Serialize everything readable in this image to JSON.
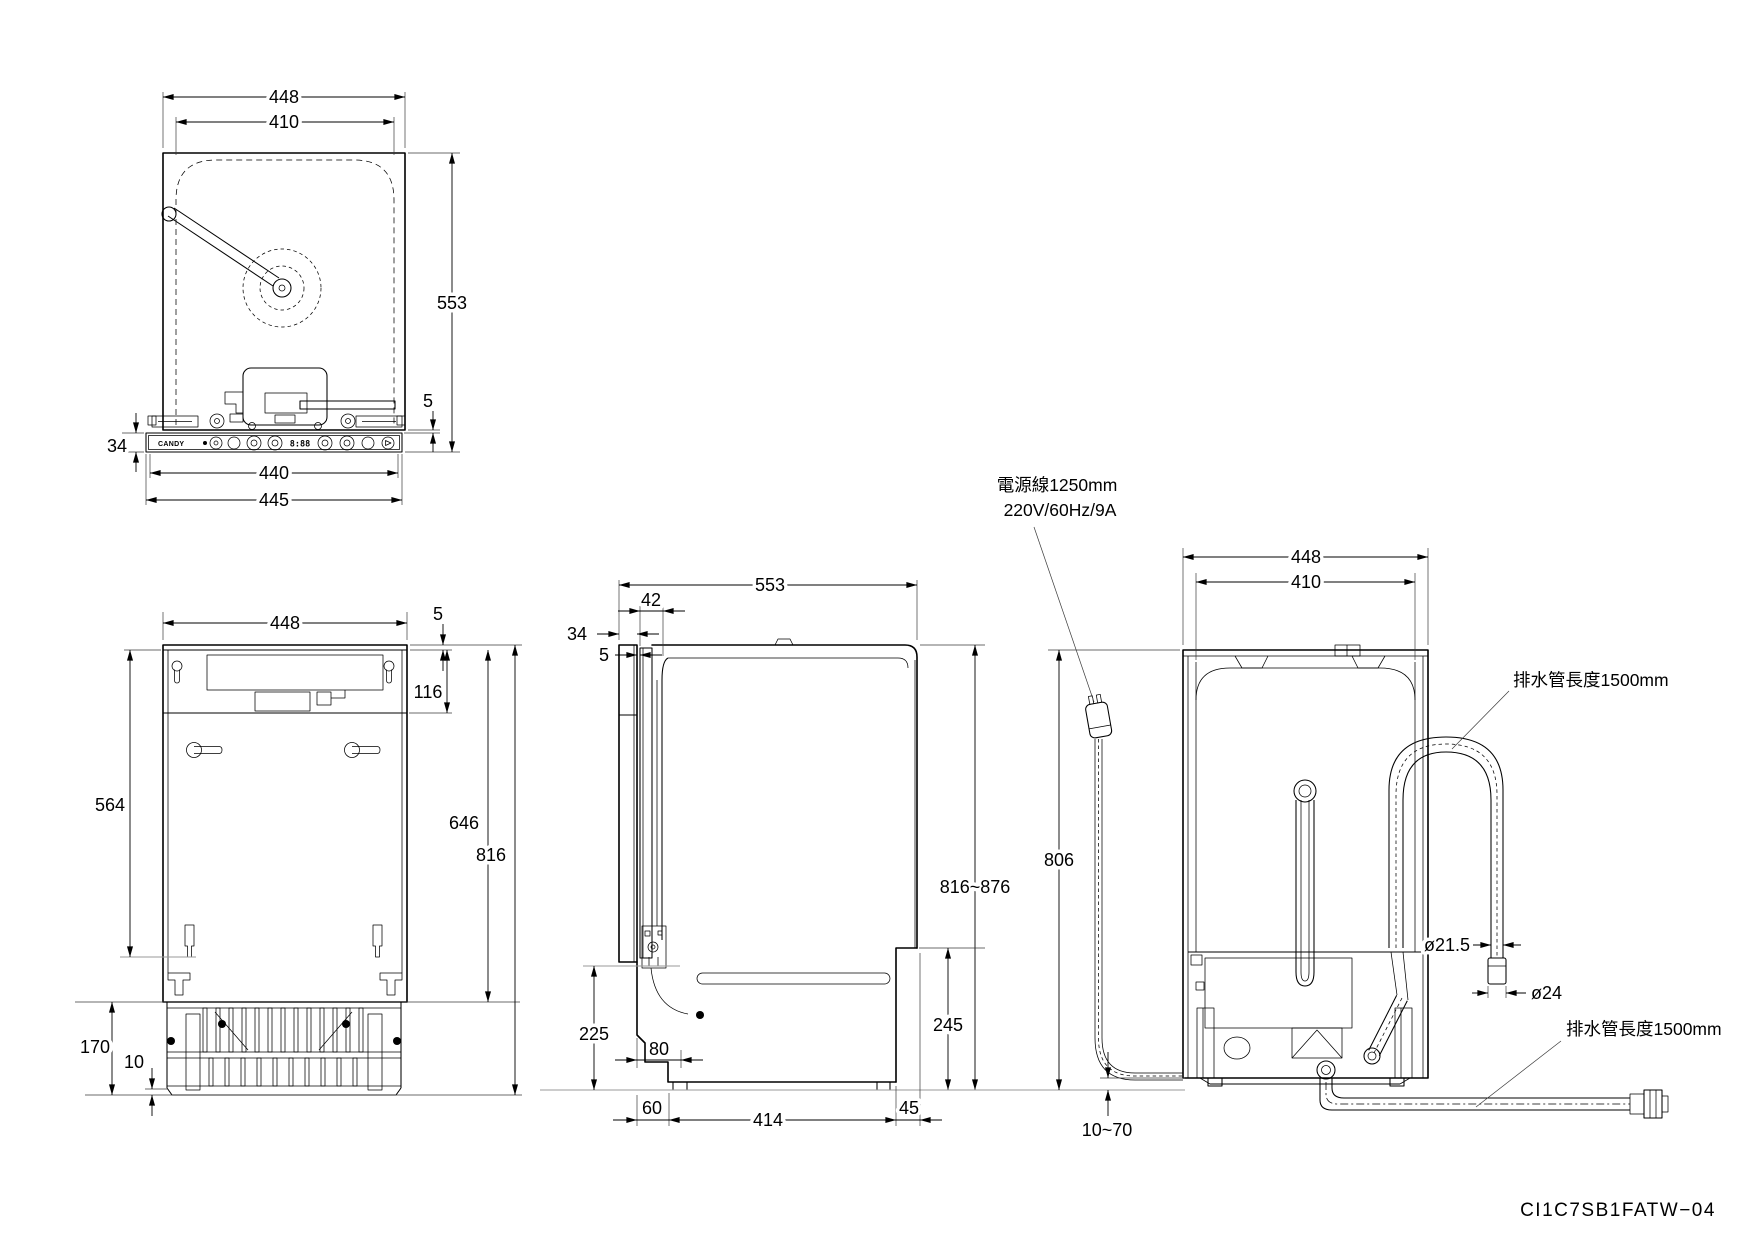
{
  "drawing": {
    "part_number": "CI1C7SB1FATW−04"
  },
  "top_view": {
    "width_outer": "448",
    "width_door": "410",
    "depth": "553",
    "gap_body_panel": "5",
    "panel_height": "34",
    "panel_width_inner": "440",
    "panel_width_outer": "445",
    "brand": "CANDY",
    "display": "8:88"
  },
  "front_view": {
    "width": "448",
    "top_gap": "5",
    "top_section": "116",
    "side_height": "564",
    "tub_height": "646",
    "overall_height": "816",
    "base_height": "170",
    "base_lip": "10"
  },
  "side_view": {
    "depth": "553",
    "door_offset": "42",
    "panel_thickness": "34",
    "panel_gap": "5",
    "overall_height": "816~876",
    "hinge_height": "225",
    "base_back_height": "245",
    "toe_depth": "80",
    "foot_setback": "60",
    "foot_span": "414",
    "back_offset": "45"
  },
  "back_view": {
    "width": "448",
    "inner_width": "410",
    "body_height": "806",
    "foot_range": "10~70",
    "hose_diameter": "ø21.5",
    "hose_end_diameter": "ø24",
    "power_cord_label": "電源線1250mm",
    "power_cord_spec": "220V/60Hz/9A",
    "drain_hose_label_top": "排水管長度1500mm",
    "drain_hose_label_bottom": "排水管長度1500mm"
  }
}
